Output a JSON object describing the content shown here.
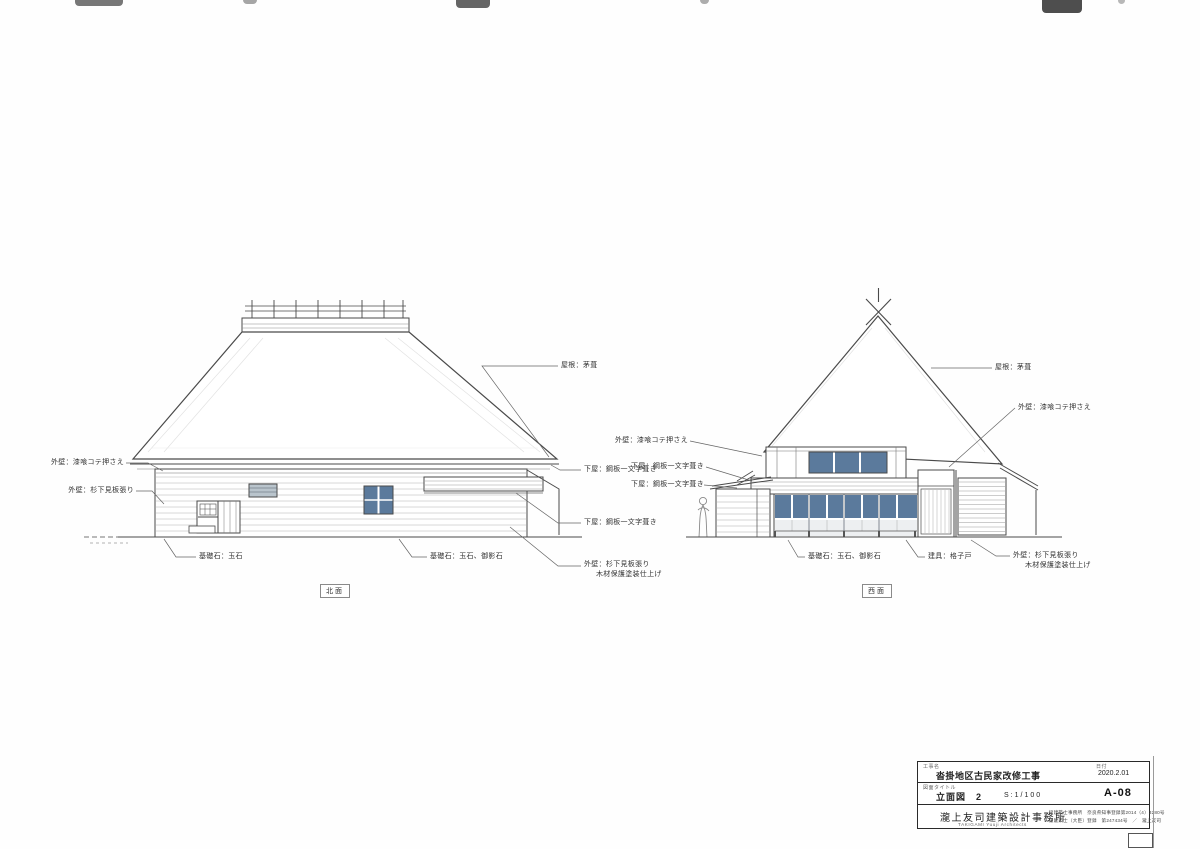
{
  "drawings": {
    "north": {
      "caption": "北面",
      "labels": {
        "wall_plaster": "外壁：漆喰コテ押さえ",
        "wall_siding": "外壁：杉下見板張り",
        "roof": "屋根：茅葺",
        "pent_roof_1": "下屋：鋼板一文字葺き",
        "pent_roof_2": "下屋：鋼板一文字葺き",
        "wall_siding_lower_1": "外壁：杉下見板張り",
        "wall_siding_lower_2": "木材保護塗装仕上げ",
        "foundation_1": "基礎石：玉石",
        "foundation_2": "基礎石：玉石、御影石"
      }
    },
    "west": {
      "caption": "西面",
      "labels": {
        "wall_plaster_left": "外壁：漆喰コテ押さえ",
        "pent_roof_1": "下屋：鋼板一文字葺き",
        "pent_roof_2": "下屋：鋼板一文字葺き",
        "roof": "屋根：茅葺",
        "wall_plaster_right": "外壁：漆喰コテ押さえ",
        "foundation": "基礎石：玉石、御影石",
        "fitting": "建具：格子戸",
        "wall_siding_1": "外壁：杉下見板張り",
        "wall_siding_2": "木材保護塗装仕上げ"
      }
    }
  },
  "title_block": {
    "project_label": "工事名",
    "project_name": "沓掛地区古民家改修工事",
    "date_label": "日付",
    "date": "2020.2.01",
    "drawing_label": "図面タイトル",
    "drawing_title": "立面図　2",
    "scale": "S:1/100",
    "sheet_no": "A-08",
    "office_name": "瀧上友司建築設計事務所",
    "office_name_en": "TAKIGAMI Yuuji Architects",
    "registration1": "一級建築士事務所　奈良県知事登録第2014（4）3280号",
    "registration2": "一級建築士（大臣）登録　第247434号　／　瀧上友司"
  },
  "colors": {
    "line": "#4a4a4a",
    "glass": "#5b7a9c",
    "paper": "#fefefe"
  }
}
